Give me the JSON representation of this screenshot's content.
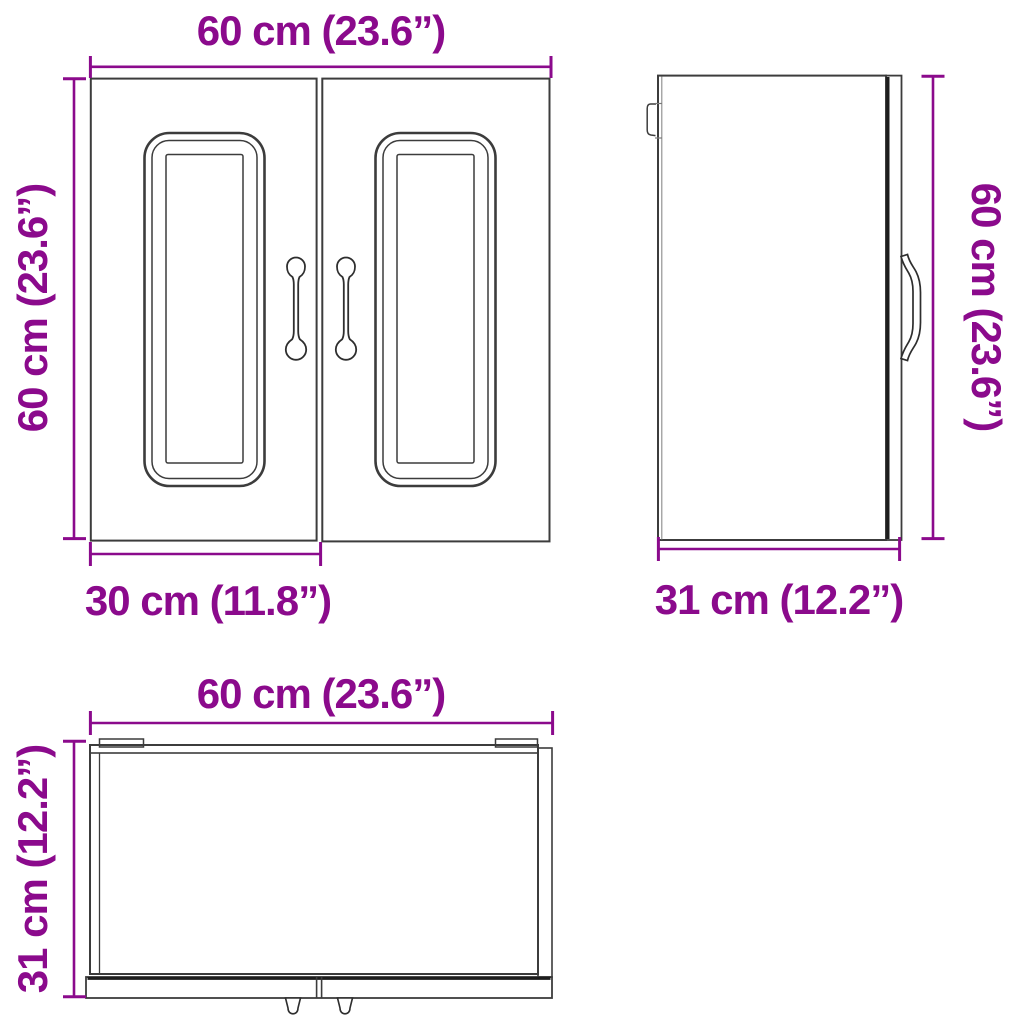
{
  "page": {
    "background_color": "#ffffff",
    "accent_color": "#8B0A8C",
    "line_color": "#3c3c3c",
    "description_of_views": [
      "front-view",
      "side-view",
      "top-view"
    ]
  },
  "views": {
    "front": {
      "width_label": "60 cm (23.6”)",
      "height_label": "60 cm (23.6”)",
      "door_width_label": "30 cm (11.8”)"
    },
    "side": {
      "height_label": "60 cm (23.6”)",
      "depth_label": "31 cm (12.2”)"
    },
    "top": {
      "width_label": "60 cm (23.6”)",
      "depth_label": "31 cm (12.2”)"
    }
  },
  "dimensions": {
    "width_cm": 60,
    "width_in": 23.6,
    "height_cm": 60,
    "height_in": 23.6,
    "depth_cm": 31,
    "depth_in": 12.2,
    "door_width_cm": 30,
    "door_width_in": 11.8
  }
}
